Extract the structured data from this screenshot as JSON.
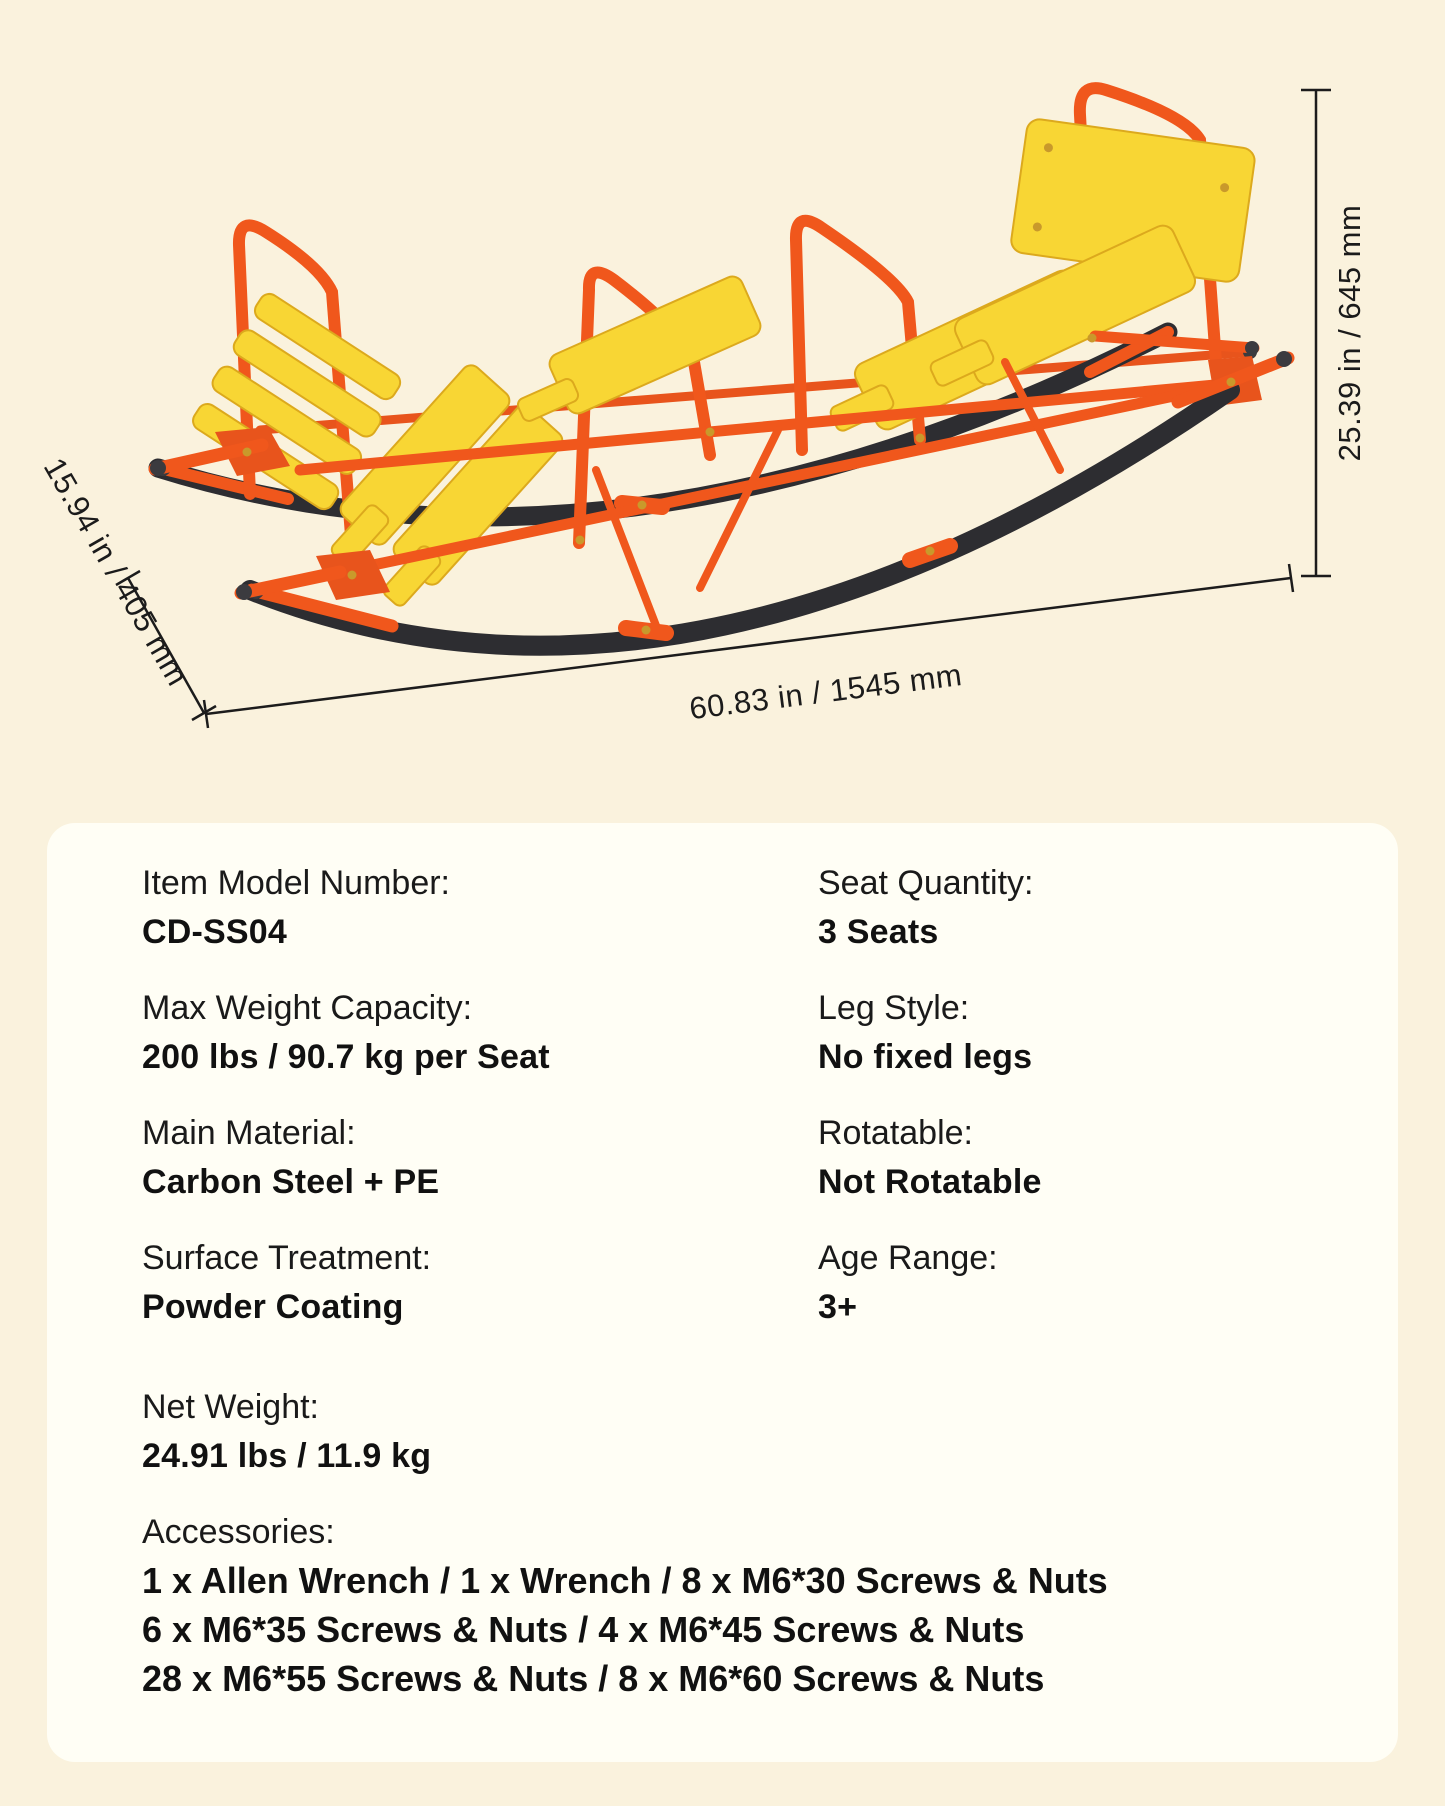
{
  "page": {
    "background_color": "#FAF2DD",
    "panel_color": "#FFFEF5"
  },
  "figure": {
    "dim_height": "25.39 in / 645 mm",
    "dim_depth": "15.94 in / 405 mm",
    "dim_length": "60.83 in / 1545 mm",
    "colors": {
      "frame_orange": "#F0571C",
      "bracket_orange": "#E8541C",
      "seat_yellow": "#F8D634",
      "seat_edge": "#DCA91D",
      "rocker_black": "#2D2D31",
      "cap_gray": "#3B3B3F",
      "bolt_gold": "#C9992B",
      "dimension_line": "#1C1C1C"
    }
  },
  "specs": {
    "items": [
      {
        "label": "Item Model Number:",
        "value": "CD-SS04"
      },
      {
        "label": "Seat Quantity:",
        "value": "3 Seats"
      },
      {
        "label": "Max Weight Capacity:",
        "value": "200 lbs / 90.7 kg per Seat"
      },
      {
        "label": "Leg Style:",
        "value": "No fixed legs"
      },
      {
        "label": "Main Material:",
        "value": "Carbon Steel + PE"
      },
      {
        "label": "Rotatable:",
        "value": "Not Rotatable"
      },
      {
        "label": "Surface Treatment:",
        "value": "Powder Coating"
      },
      {
        "label": "Age Range:",
        "value": "3+"
      }
    ],
    "net_weight": {
      "label": "Net Weight:",
      "value": "24.91 lbs / 11.9 kg"
    },
    "accessories": {
      "label": "Accessories:",
      "lines": [
        "1 x Allen Wrench / 1 x Wrench / 8 x M6*30 Screws & Nuts",
        "6 x M6*35 Screws & Nuts / 4 x M6*45 Screws & Nuts",
        "28 x M6*55 Screws & Nuts / 8 x M6*60 Screws & Nuts"
      ]
    }
  }
}
